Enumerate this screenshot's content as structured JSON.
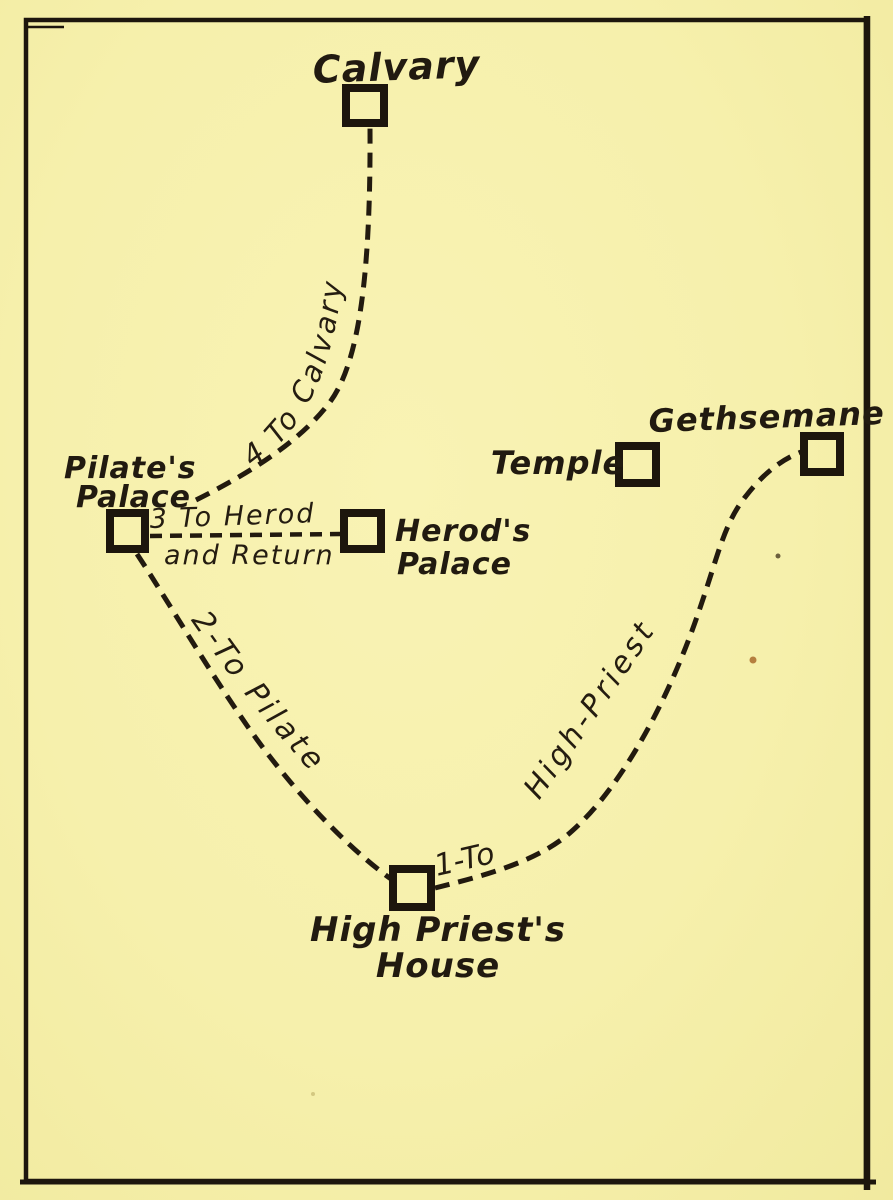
{
  "map": {
    "kind": "hand-drawn route map",
    "paper_color": "#f6f0ac",
    "ink_color": "#1d160d",
    "marker_shape": "hollow-square",
    "line_style": "dashed",
    "locations": [
      {
        "id": "calvary",
        "label": "Calvary"
      },
      {
        "id": "gethsemane",
        "label": "Gethsemane"
      },
      {
        "id": "temple",
        "label": "Temple"
      },
      {
        "id": "pilates-palace",
        "label_line1": "Pilate's",
        "label_line2": "Palace"
      },
      {
        "id": "herods-palace",
        "label_line1": "Herod's",
        "label_line2": "Palace"
      },
      {
        "id": "high-priests-house",
        "label_line1": "High Priest's",
        "label_line2": "House"
      }
    ],
    "routes": [
      {
        "number": "1",
        "label_prefix": "1-To",
        "label_main": "High-Priest",
        "connects": [
          "High Priest's House",
          "Gethsemane"
        ]
      },
      {
        "number": "2",
        "label": "2-To Pilate",
        "connects": [
          "High Priest's House",
          "Pilate's Palace"
        ]
      },
      {
        "number": "3",
        "label_line1": "3 To Herod",
        "label_line2": "and Return",
        "connects": [
          "Pilate's Palace",
          "Herod's Palace"
        ]
      },
      {
        "number": "4",
        "label": "4 To Calvary",
        "connects": [
          "Pilate's Palace",
          "Calvary"
        ]
      }
    ]
  }
}
